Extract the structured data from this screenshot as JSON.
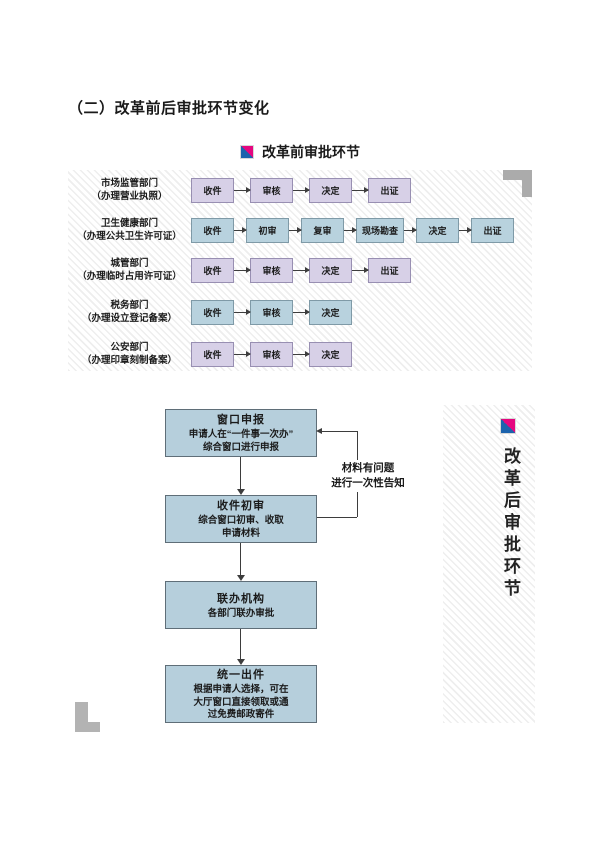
{
  "page": {
    "title": "（二）改革前后审批环节变化"
  },
  "before": {
    "heading": "改革前审批环节",
    "rows": [
      {
        "dept": "市场监管部门",
        "note": "（办理营业执照）",
        "style": "purple",
        "steps": [
          "收件",
          "审核",
          "决定",
          "出证"
        ]
      },
      {
        "dept": "卫生健康部门",
        "note": "（办理公共卫生许可证）",
        "style": "blue",
        "steps": [
          "收件",
          "初审",
          "复审",
          "现场勘查",
          "决定",
          "出证"
        ]
      },
      {
        "dept": "城管部门",
        "note": "（办理临时占用许可证）",
        "style": "purple",
        "steps": [
          "收件",
          "审核",
          "决定",
          "出证"
        ]
      },
      {
        "dept": "税务部门",
        "note": "（办理设立登记备案）",
        "style": "blue",
        "steps": [
          "收件",
          "审核",
          "决定"
        ]
      },
      {
        "dept": "公安部门",
        "note": "（办理印章刻制备案）",
        "style": "purple",
        "steps": [
          "收件",
          "审核",
          "决定"
        ]
      }
    ]
  },
  "after": {
    "heading": "改革后审批环节",
    "steps": [
      {
        "title": "窗口申报",
        "lines": [
          "申请人在“一件事一次办”",
          "综合窗口进行申报"
        ]
      },
      {
        "title": "收件初审",
        "lines": [
          "综合窗口初审、收取",
          "申请材料"
        ]
      },
      {
        "title": "联办机构",
        "lines": [
          "各部门联办审批"
        ]
      },
      {
        "title": "统一出件",
        "lines": [
          "根据申请人选择，可在",
          "大厅窗口直接领取或通",
          "过免费邮政寄件"
        ]
      }
    ],
    "feedback": {
      "lines": [
        "材料有问题",
        "进行一次性告知"
      ]
    }
  },
  "colors": {
    "icon_magenta": "#e5067f",
    "icon_blue": "#1c63ad",
    "purple_box_fill": "#d7d0e7",
    "blue_box_fill": "#b8d2de",
    "flow_box_fill": "#b6cfdc",
    "corner_gray": "#b3b3b3",
    "line_color": "#3d3d3d"
  }
}
